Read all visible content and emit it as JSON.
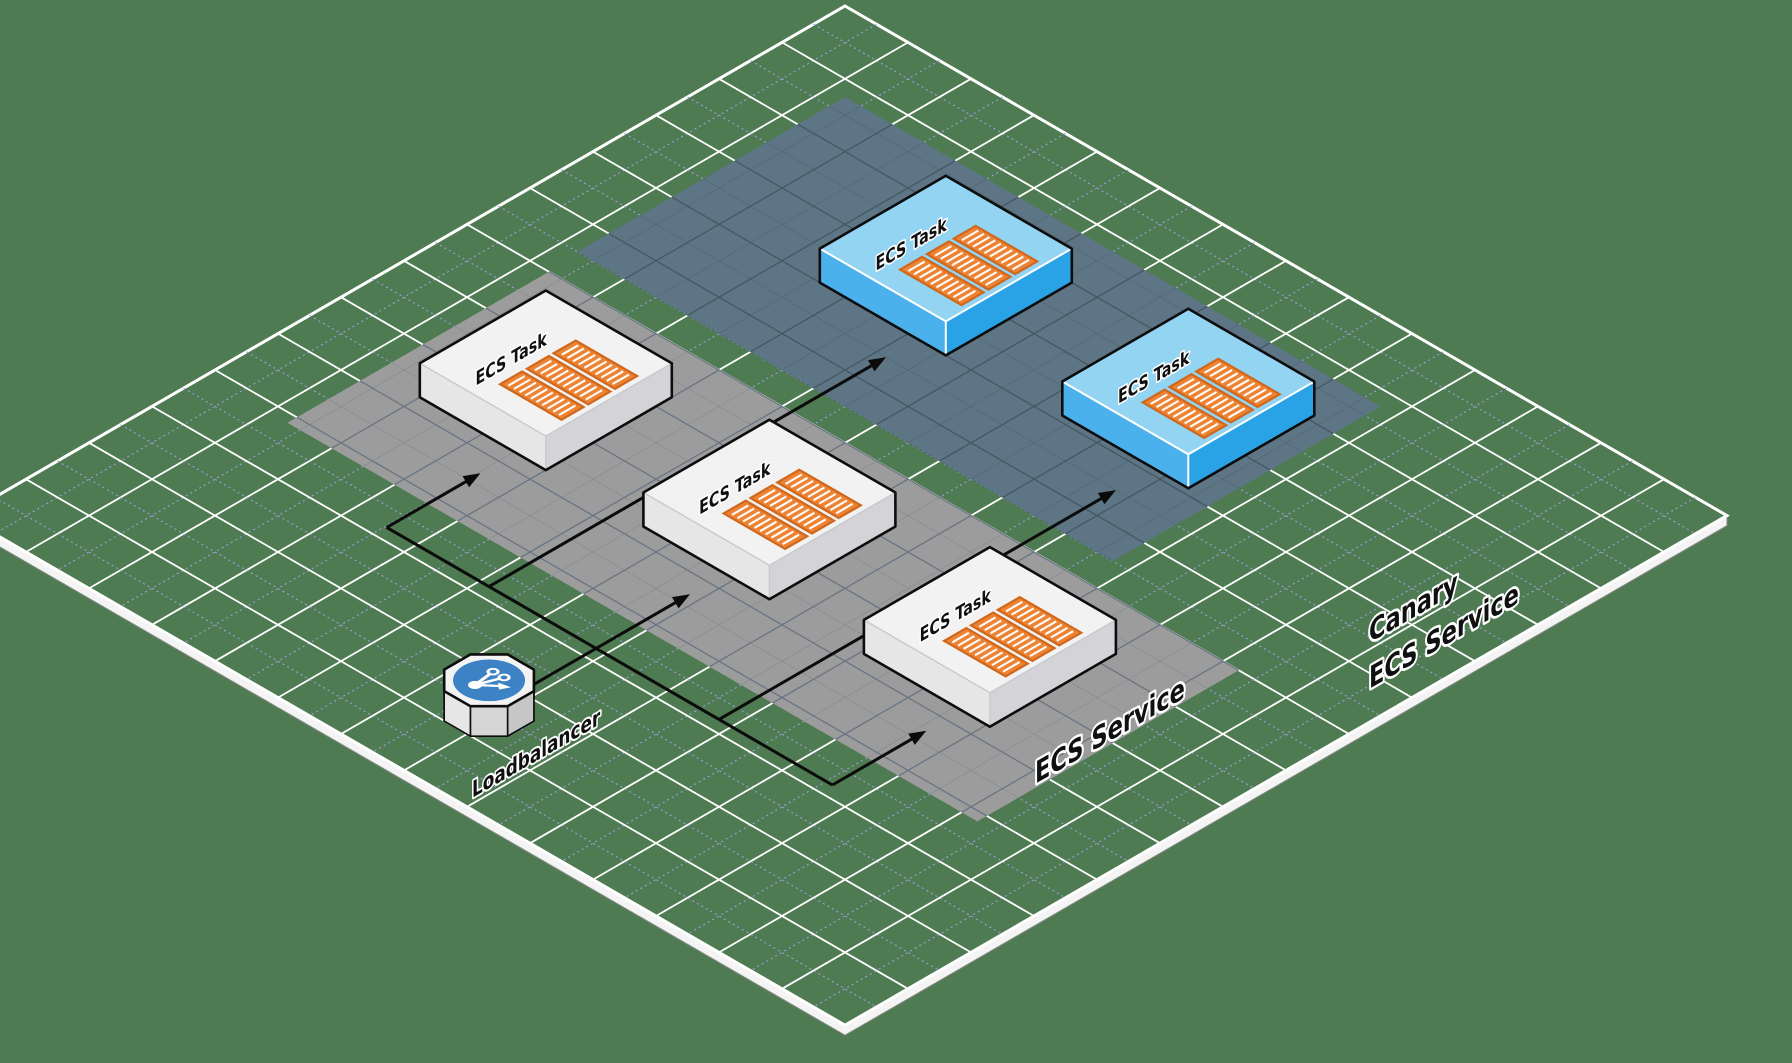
{
  "diagram": {
    "type": "isometric-architecture",
    "background_color": "#4e7b51",
    "grid": {
      "major_line_color": "#ffffff",
      "minor_line_color": "#9aa0dc",
      "plane_edge_color": "#f4f4f4"
    }
  },
  "bands": [
    {
      "id": "ecs-service",
      "label": "ECS Service",
      "fill": "#9c9c9c",
      "line_color": "#6a7484",
      "i0": 2.6,
      "i1": 24.5,
      "j0": 12.0,
      "j1": 20.3,
      "label_x": 1035,
      "label_y": 784,
      "label_size": 26
    },
    {
      "id": "canary-ecs-service",
      "label_line1": "Canary",
      "label_line2": "ECS Service",
      "fill": "#5d7585",
      "line_color": "#465761",
      "i0": 2.5,
      "i1": 19.5,
      "j0": 2.5,
      "j1": 11.0,
      "label_x": 1369,
      "label_y": 643,
      "label_size": 26,
      "label_line_gap": 46
    }
  ],
  "tasks": [
    {
      "id": "ecs-task-1",
      "label": "ECS Task",
      "variant": "standard",
      "i": 4.0,
      "j": 13.5
    },
    {
      "id": "ecs-task-2",
      "label": "ECS Task",
      "variant": "standard",
      "i": 11.1,
      "j": 13.5
    },
    {
      "id": "ecs-task-3",
      "label": "ECS Task",
      "variant": "standard",
      "i": 18.1,
      "j": 13.5
    },
    {
      "id": "canary-task-1",
      "label": "ECS Task",
      "variant": "canary",
      "i": 7.2,
      "j": 4.0
    },
    {
      "id": "canary-task-2",
      "label": "ECS Task",
      "variant": "canary",
      "i": 14.7,
      "j": 3.8
    }
  ],
  "task_style": {
    "standard": {
      "top": "#f2f2f2",
      "left": "#e6e6e6",
      "right": "#d4d4d8",
      "inner_edge": "#c6cacd"
    },
    "canary": {
      "top": "#93d4f3",
      "left": "#4ab1ec",
      "right": "#2aa2e6",
      "inner_edge": "#ffffff"
    },
    "outline": "#0d0d0d",
    "container_fill": "#ee8433",
    "container_border": "#cf681c",
    "container_stripe": "#ffffff",
    "label_size": 16.5
  },
  "loadbalancer": {
    "id": "load-balancer",
    "label": "Loadbalancer",
    "i": 13.7,
    "j": 25.0,
    "top": "#f3f3f3",
    "outline": "#0d0d0d",
    "circle_color": "#3d82c4",
    "glyph_color": "#ffffff",
    "label_x": 472,
    "label_y": 798,
    "label_size": 19.5
  },
  "edges": [
    {
      "id": "trunk",
      "pts": [
        [
          7.05,
          21.6
        ],
        [
          21.2,
          21.6
        ]
      ],
      "arrow": false
    },
    {
      "id": "lb-to-task-2",
      "pts": [
        [
          13.7,
          25.0
        ],
        [
          13.7,
          18.62
        ]
      ],
      "arrow": true
    },
    {
      "id": "to-task-1",
      "pts": [
        [
          7.05,
          21.6
        ],
        [
          7.05,
          18.62
        ]
      ],
      "arrow": true
    },
    {
      "id": "to-task-3",
      "pts": [
        [
          21.2,
          21.6
        ],
        [
          21.2,
          18.62
        ]
      ],
      "arrow": true
    },
    {
      "id": "to-canary-1",
      "pts": [
        [
          10.3,
          21.6
        ],
        [
          10.3,
          9.0
        ]
      ],
      "arrow": true
    },
    {
      "id": "to-canary-2",
      "pts": [
        [
          17.6,
          21.6
        ],
        [
          17.6,
          9.0
        ]
      ],
      "arrow": true
    }
  ],
  "edge_style": {
    "color": "#0b0b0b",
    "width": 3
  }
}
